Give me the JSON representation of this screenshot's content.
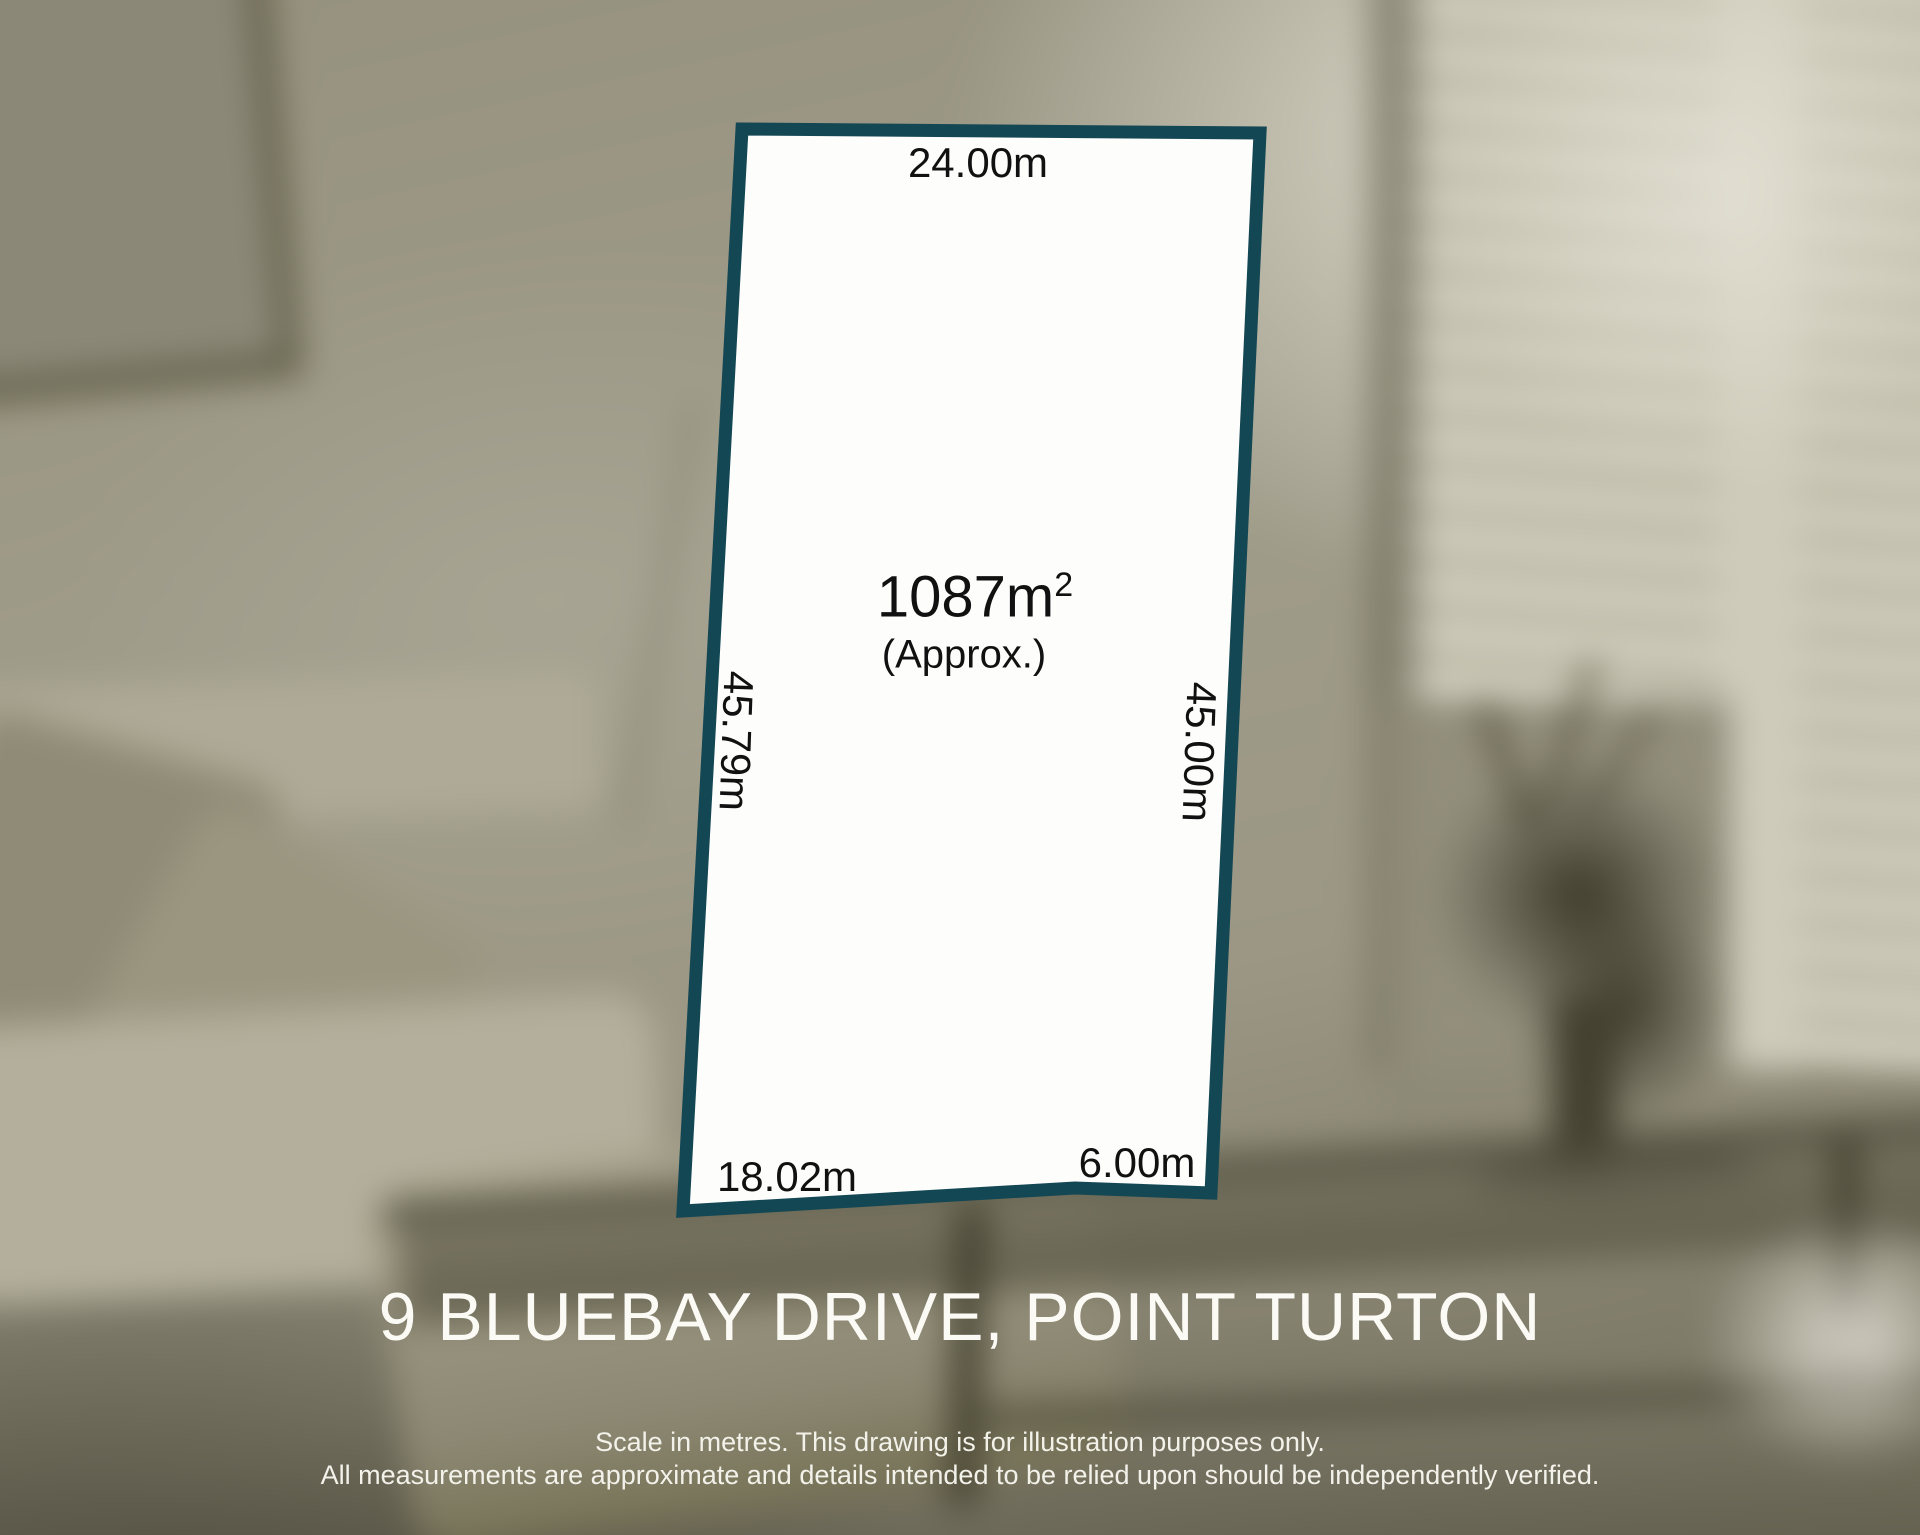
{
  "diagram": {
    "area": {
      "value": "1087m",
      "exponent": "2",
      "qualifier": "(Approx.)"
    },
    "dimensions": {
      "top": "24.00m",
      "left": "45.79m",
      "right": "45.00m",
      "bottom_left": "18.02m",
      "bottom_right": "6.00m"
    },
    "colors": {
      "boundary": "#144754",
      "lot_fill": "#fdfdfc",
      "label_text": "#111111"
    }
  },
  "footer": {
    "address": "9 BLUEBAY DRIVE, POINT TURTON",
    "disclaimer_line1": "Scale in metres. This drawing is for illustration purposes only.",
    "disclaimer_line2": "All measurements are approximate and details intended to be relied upon should be independently verified."
  }
}
